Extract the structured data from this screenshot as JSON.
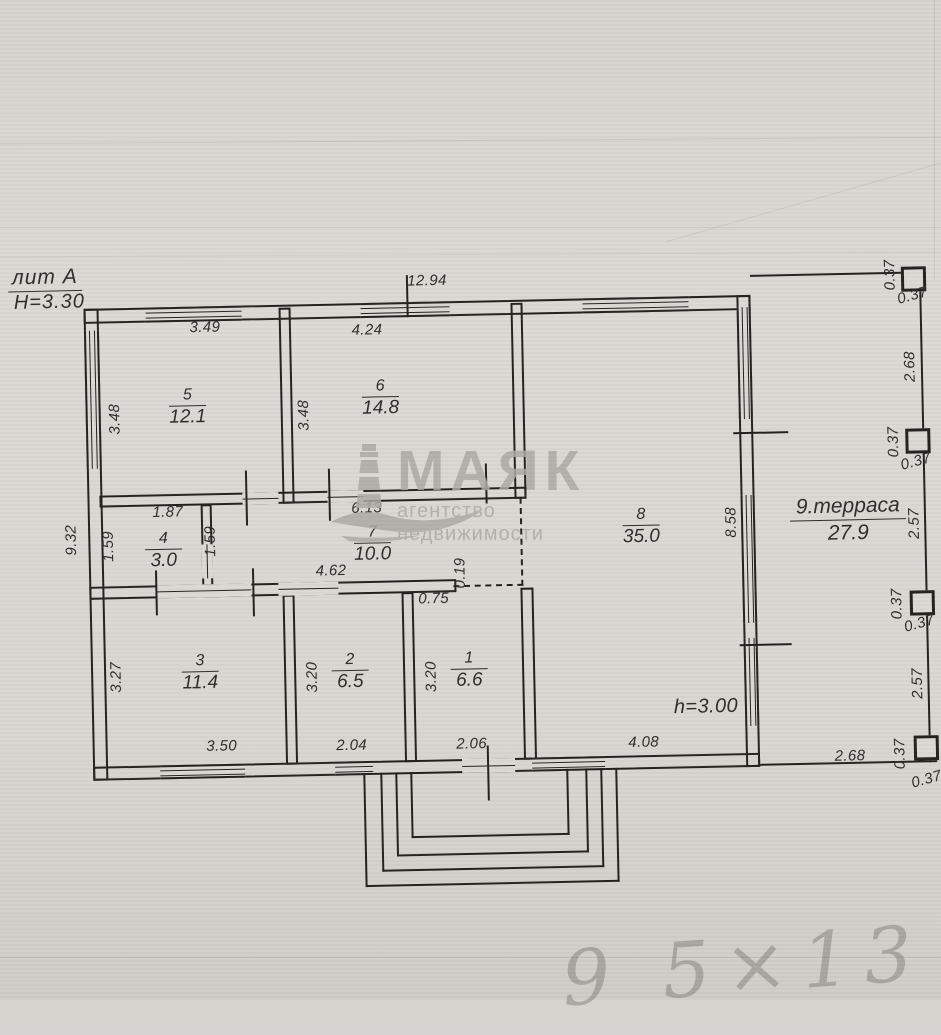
{
  "title_block": {
    "litera": "лит А",
    "height_note": "Н=3.30"
  },
  "watermark": {
    "brand": "МАЯК",
    "tagline": "агентство недвижимости"
  },
  "rooms": [
    {
      "num": "1",
      "area": "6.6"
    },
    {
      "num": "2",
      "area": "6.5"
    },
    {
      "num": "3",
      "area": "11.4"
    },
    {
      "num": "4",
      "area": "3.0"
    },
    {
      "num": "5",
      "area": "12.1"
    },
    {
      "num": "6",
      "area": "14.8"
    },
    {
      "num": "7",
      "area": "10.0"
    },
    {
      "num": "8",
      "area": "35.0"
    },
    {
      "num": "9.терраса",
      "area": "27.9"
    }
  ],
  "dimensions": {
    "total_width": "12.94",
    "total_height": "9.32",
    "room5_width": "3.49",
    "room5_height": "3.48",
    "room5_height_right": "3.48",
    "room6_width": "4.24",
    "room4_width": "1.87",
    "room4_height": "1.59",
    "room4_height_right": "1.59",
    "hall_length": "6.13",
    "hall_width": "4.62",
    "offset": "0.19",
    "wall_stub": "0.75",
    "room3_height": "3.27",
    "room3_width": "3.50",
    "room2_height": "3.20",
    "room2_width": "2.04",
    "room1_height": "3.20",
    "room1_width": "2.06",
    "room8_width": "4.08",
    "room8_height": "8.58",
    "ceiling_height": "h=3.00",
    "terrace_bottom": "2.68",
    "terrace_right_top": "2.68",
    "terrace_right_mid": "2.57",
    "terrace_right_low": "2.57",
    "post_size": "0.37"
  },
  "annotations": {
    "handwriting": "9 5×13"
  }
}
